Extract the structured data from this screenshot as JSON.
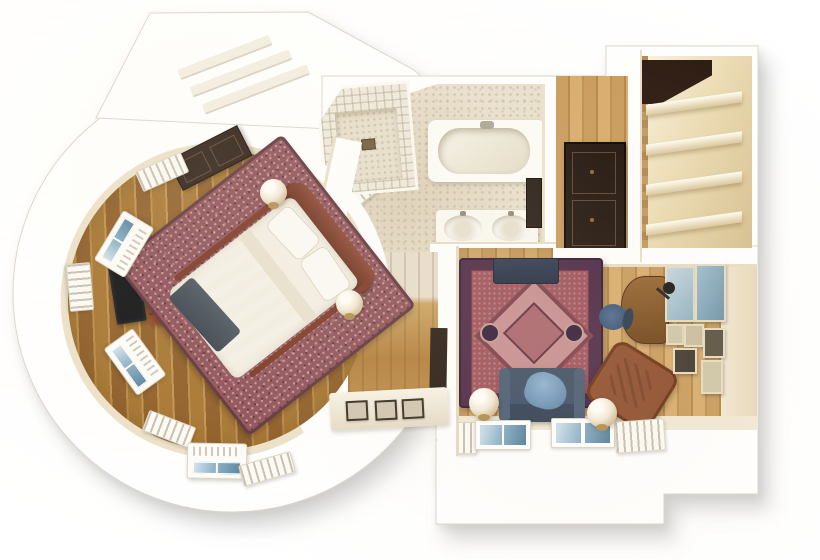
{
  "scene": {
    "title": "watercolor-apartment-floor-plan",
    "canvas": {
      "width": 820,
      "height": 560
    },
    "style": "hand-painted top-down 3D floor plan on white background, soft gray drop shadow to lower right",
    "rooms": [
      {
        "id": "bedroom",
        "label": "round bedroom",
        "floor": "honey parquet planks",
        "furniture": [
          "canopy-bed",
          "speckled-area-rug",
          "sage-blanket",
          "dark-throw",
          "red-brown-headboard",
          "globe-lamp-left",
          "globe-lamp-right",
          "flat-tv",
          "red-chest",
          "dark-dresser",
          "curved-window-bays",
          "radiator-covers",
          "picture-ledge-three-frames"
        ]
      },
      {
        "id": "bathroom",
        "label": "bathroom",
        "floor": "beige mosaic tile",
        "furniture": [
          "corner-shower",
          "bathtub",
          "double-sink-vanity",
          "towel-radiator",
          "wall-mirror"
        ]
      },
      {
        "id": "hallway",
        "label": "entry hall",
        "floor": "oak plank",
        "furniture": [
          "dark-wardrobe"
        ]
      },
      {
        "id": "closet",
        "label": "walk-in closet",
        "floor": "cream",
        "furniture": [
          "shelving-four-tiers",
          "dark-storage-box"
        ]
      },
      {
        "id": "living",
        "label": "living room",
        "floor": "oak plank",
        "furniture": [
          "oriental-rug",
          "navy-sofa",
          "blue-throw",
          "media-console",
          "leather-armchair",
          "writing-desk",
          "office-chair",
          "desk-lamp",
          "gallery-wall-frames",
          "globe-lamp-left",
          "globe-lamp-right",
          "twin-windows",
          "radiator-covers"
        ]
      }
    ],
    "palette": {
      "background": "#ffffff",
      "wall_white": "#ffffff",
      "wall_cream": "#ece1c8",
      "outline": "#dcd6ca",
      "parquet_dark": "#8f5d26",
      "parquet_light": "#c79a5b",
      "bedroom_rug": "#8d4f57",
      "bed_linen": "#f2eee3",
      "bed_blanket": "#a3ae9e",
      "bed_throw": "#4c555f",
      "headboard": "#7a3a28",
      "bath_floor": "#e8dfcd",
      "tile_line": "#a0968a",
      "living_rug_border": "#4a2545",
      "living_rug_field": "#9c4f5a",
      "living_rug_medallion": "#c68d90",
      "sofa_navy": "#3c4d64",
      "sofa_throw": "#8fb2d2",
      "leather": "#8d4c2c",
      "desk_wood": "#95642f",
      "wardrobe_dark": "#1f130c",
      "window_glass": "#8cb0c6",
      "shadow": "rgba(0,0,0,0.22)"
    }
  }
}
